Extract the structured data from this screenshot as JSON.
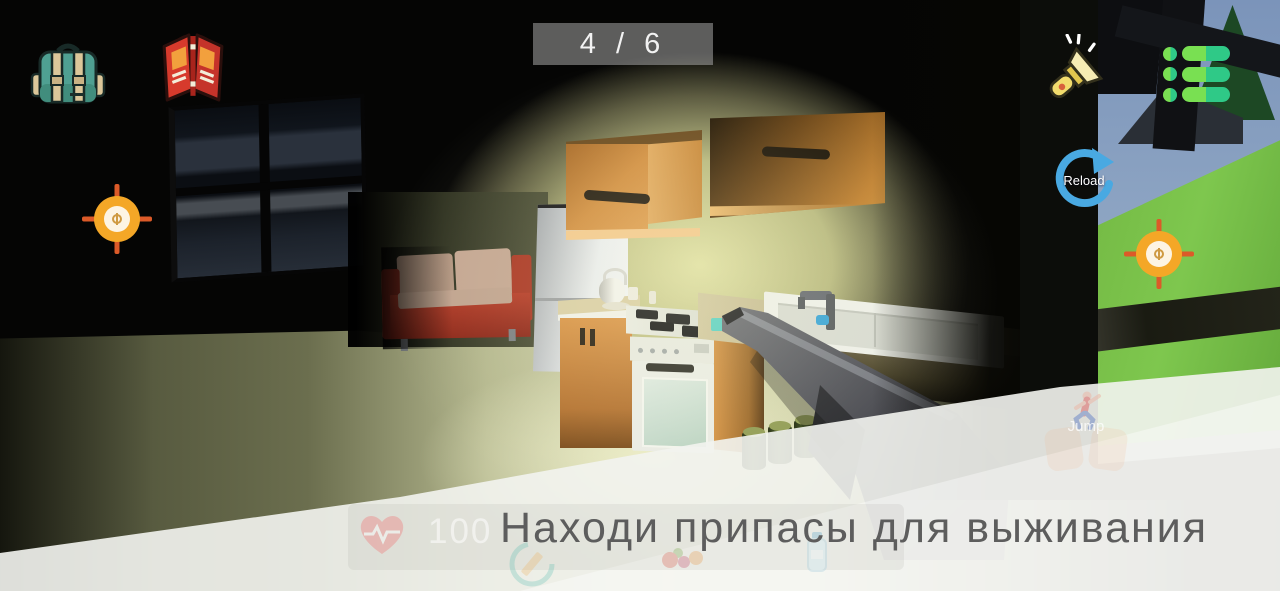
{
  "hud": {
    "ammo_counter": "4 / 6",
    "reload_label": "Reload",
    "jump_label": "Jump",
    "health_value": "100",
    "tutorial_message": "Находи припасы для выживания"
  },
  "icons": {
    "top_left": [
      "backpack-icon",
      "book-icon"
    ],
    "top_right": [
      "flashlight-icon",
      "menu-icon"
    ],
    "reload": "reload-circular-arrow-icon",
    "targets": "crosshair-icon",
    "stats": [
      "heart-icon",
      "compass-icon",
      "food-icon",
      "water-bottle-icon"
    ],
    "jump": "jump-person-icon"
  },
  "colors": {
    "menu_green": "#79e052",
    "menu_teal": "#2fc987",
    "reload_blue": "#49a9e2",
    "crosshair_orange": "#f4a727",
    "crosshair_tick_red": "#dc5a28",
    "ammo_box_bg": "#a5a5a5",
    "tutorial_text": "#5d5d5d",
    "overlay_white": "#f2f3ee",
    "heart_pink": "#ee8383",
    "cabinet_orange": "#d18e40",
    "couch_red": "#a93522"
  }
}
